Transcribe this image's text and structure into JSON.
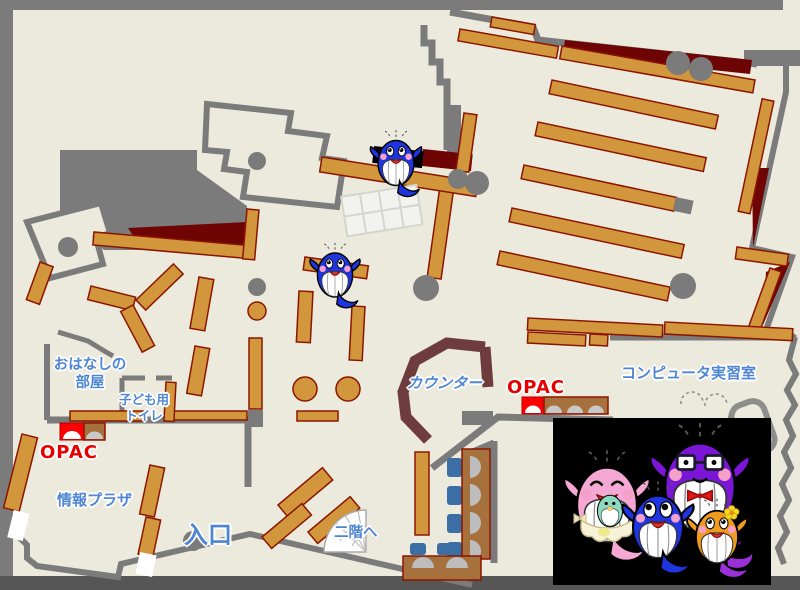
{
  "page": {
    "title": "library-floor-map"
  },
  "labels": {
    "storytelling_room": {
      "line1": "おはなしの",
      "line2": "部屋"
    },
    "kids_toilet": {
      "line1": "子ども用",
      "line2": "トイレ"
    },
    "opac_left": "OPAC",
    "opac_right": "OPAC",
    "info_plaza": "情報プラザ",
    "entrance": "入口",
    "to_second_floor": "二階へ",
    "counter": "カウンター",
    "computer_room": "コンピュータ実習室"
  },
  "icons": {
    "opac_terminal": "arch-terminal-icon",
    "stairs": "fan-stairs-icon",
    "whale": "whale-mascot"
  },
  "colors": {
    "background": "#ECEADC",
    "wall": "#7B7B7B",
    "frame_bottom": "#565656",
    "shelf": "#D2973C",
    "shelf_border": "#8B1500",
    "dark_red": "#6E0404",
    "counter": "#6E3C3C",
    "label_blue": "#4E86D2",
    "label_red": "#E60000",
    "table_brown": "#A6713C",
    "chair_blue": "#3B6EA5",
    "seat_gray": "#BDBDBD",
    "opac_red": "#FF0000",
    "black_panel": "#000000",
    "whale_blue": "#1F35E0",
    "whale_purple": "#7B16D8",
    "whale_pink": "#F5A8D3",
    "whale_orange": "#F09A1E",
    "whale_baby_green": "#8ED9C2",
    "flower_yellow": "#F2D925"
  }
}
